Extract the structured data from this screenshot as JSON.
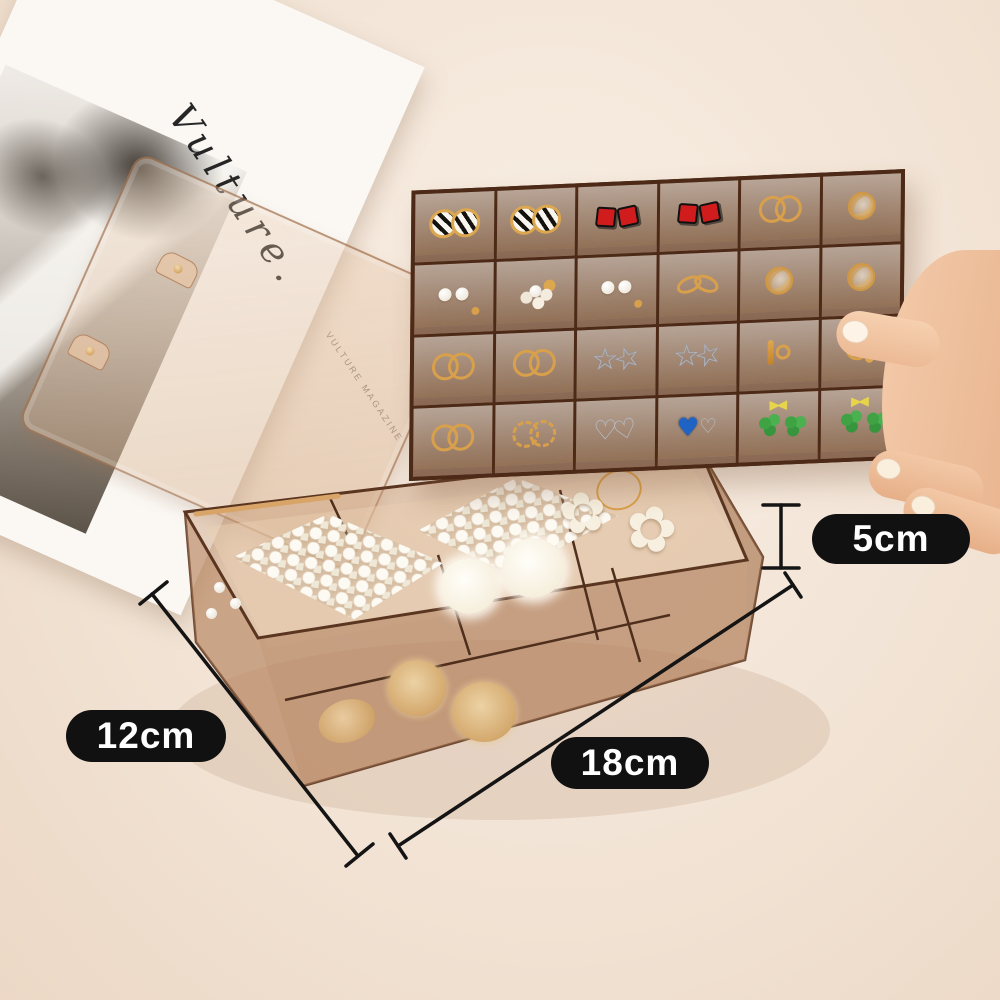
{
  "scene": {
    "background_color": "#f6ebdf",
    "subject": "transparent amber acrylic jewelry organizer box with removable earring tray held by a hand"
  },
  "magazine": {
    "script_title": "Vulture.",
    "side_text": "VULTURE MAGAZINE"
  },
  "measurements": {
    "height": {
      "label": "5cm"
    },
    "width": {
      "label": "12cm"
    },
    "length": {
      "label": "18cm"
    },
    "pill_bg": "#111111",
    "pill_text_color": "#ffffff",
    "line_color": "#141414"
  },
  "tray": {
    "rows": 4,
    "cols": 6,
    "frame_color": "#4c2a17",
    "tint_color": "rgba(198,152,114,0.42)",
    "cells": [
      [
        "striped-hoop-earrings",
        "striped-hoop-earrings",
        "red-square-earrings",
        "red-square-earrings",
        "gold-hoop-earrings",
        "gold-wire-ball-earrings"
      ],
      [
        "pearl-stud-earrings",
        "pearl-cluster-earrings",
        "pearl-stud-earrings",
        "gold-knot-earrings",
        "gold-wire-ball-earrings",
        "gold-wire-ball-earrings"
      ],
      [
        "gold-hoop-earrings",
        "gold-hoop-earrings",
        "silver-star-earrings",
        "silver-star-earrings",
        "gold-dangle-earrings",
        "gold-drop-earrings"
      ],
      [
        "gold-hoop-earrings",
        "gold-twist-hoop-earrings",
        "silver-heart-earrings",
        "blue-gem-earrings",
        "clover-bow-earrings",
        "clover-bow-earrings"
      ]
    ]
  },
  "base_box": {
    "tint_color": "rgba(198,152,114,0.42)",
    "items": [
      "pearl-barrette",
      "pearl-barrette",
      "white-flower-hair-ties",
      "fur-pompom-clips",
      "straw-scrunchies",
      "tan-scrunchie",
      "loose-pearls"
    ],
    "flower_glyph": "✿"
  },
  "hand": {
    "skin_color": "#f2c7a8"
  }
}
